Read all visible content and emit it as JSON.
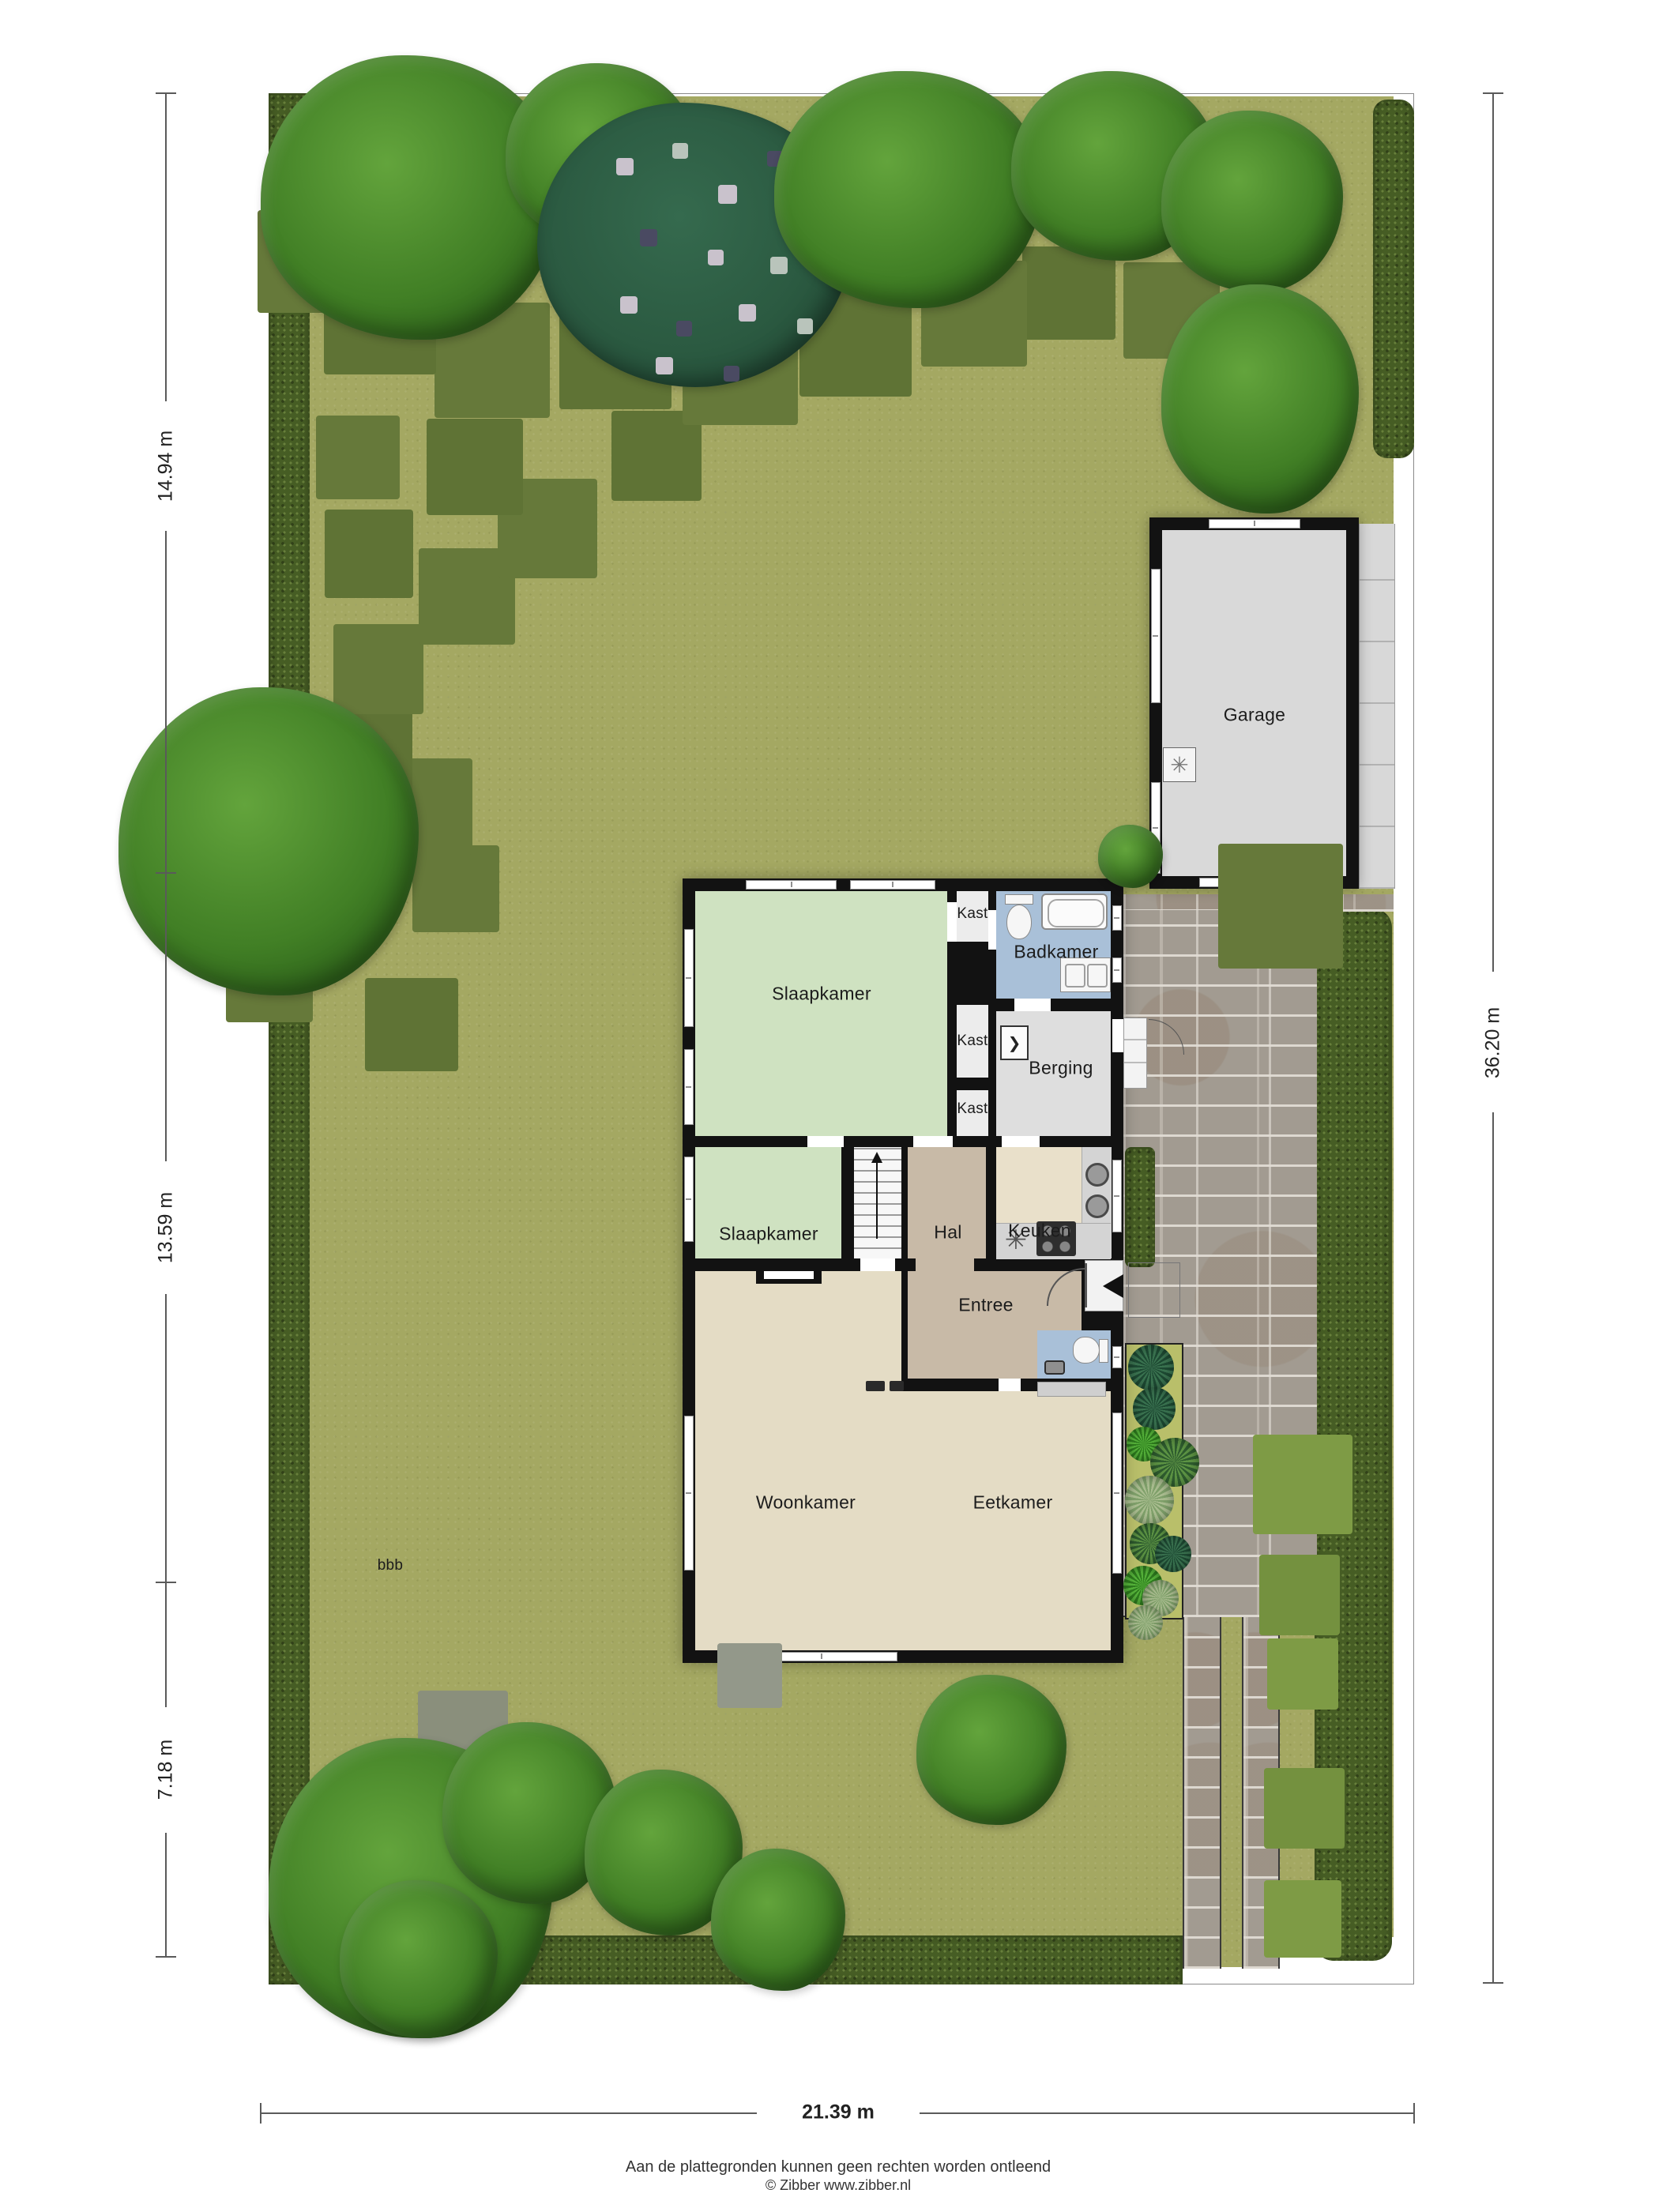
{
  "plan_type": "garden-situation-floorplan",
  "rooms": {
    "garage": "Garage",
    "slaapkamer": "Slaapkamer",
    "badkamer": "Badkamer",
    "berging": "Berging",
    "kast": "Kast",
    "hal": "Hal",
    "keuken": "Keuken",
    "entree": "Entree",
    "woonkamer": "Woonkamer",
    "eetkamer": "Eetkamer"
  },
  "dimensions": {
    "left_top": "14.94 m",
    "left_middle": "13.59 m",
    "left_bottom": "7.18 m",
    "right_side": "36.20 m",
    "bottom": "21.39 m"
  },
  "garden_note": "bbb",
  "footer": {
    "line1": "Aan de plattegronden kunnen geen rechten worden ontleend",
    "line2": "© Zibber www.zibber.nl"
  },
  "colors": {
    "grass": "#a4a862",
    "hedge": "#465d24",
    "wall": "#121212",
    "room_green": "#cfe2c1",
    "room_blue": "#a9c0d8",
    "room_tan": "#c8baa7",
    "room_cream": "#e9e0ca",
    "room_beige": "#e4dcc5",
    "room_gray": "#dedede",
    "paving_brick": "#a29b91",
    "paving_slab": "#d8d8d8"
  }
}
